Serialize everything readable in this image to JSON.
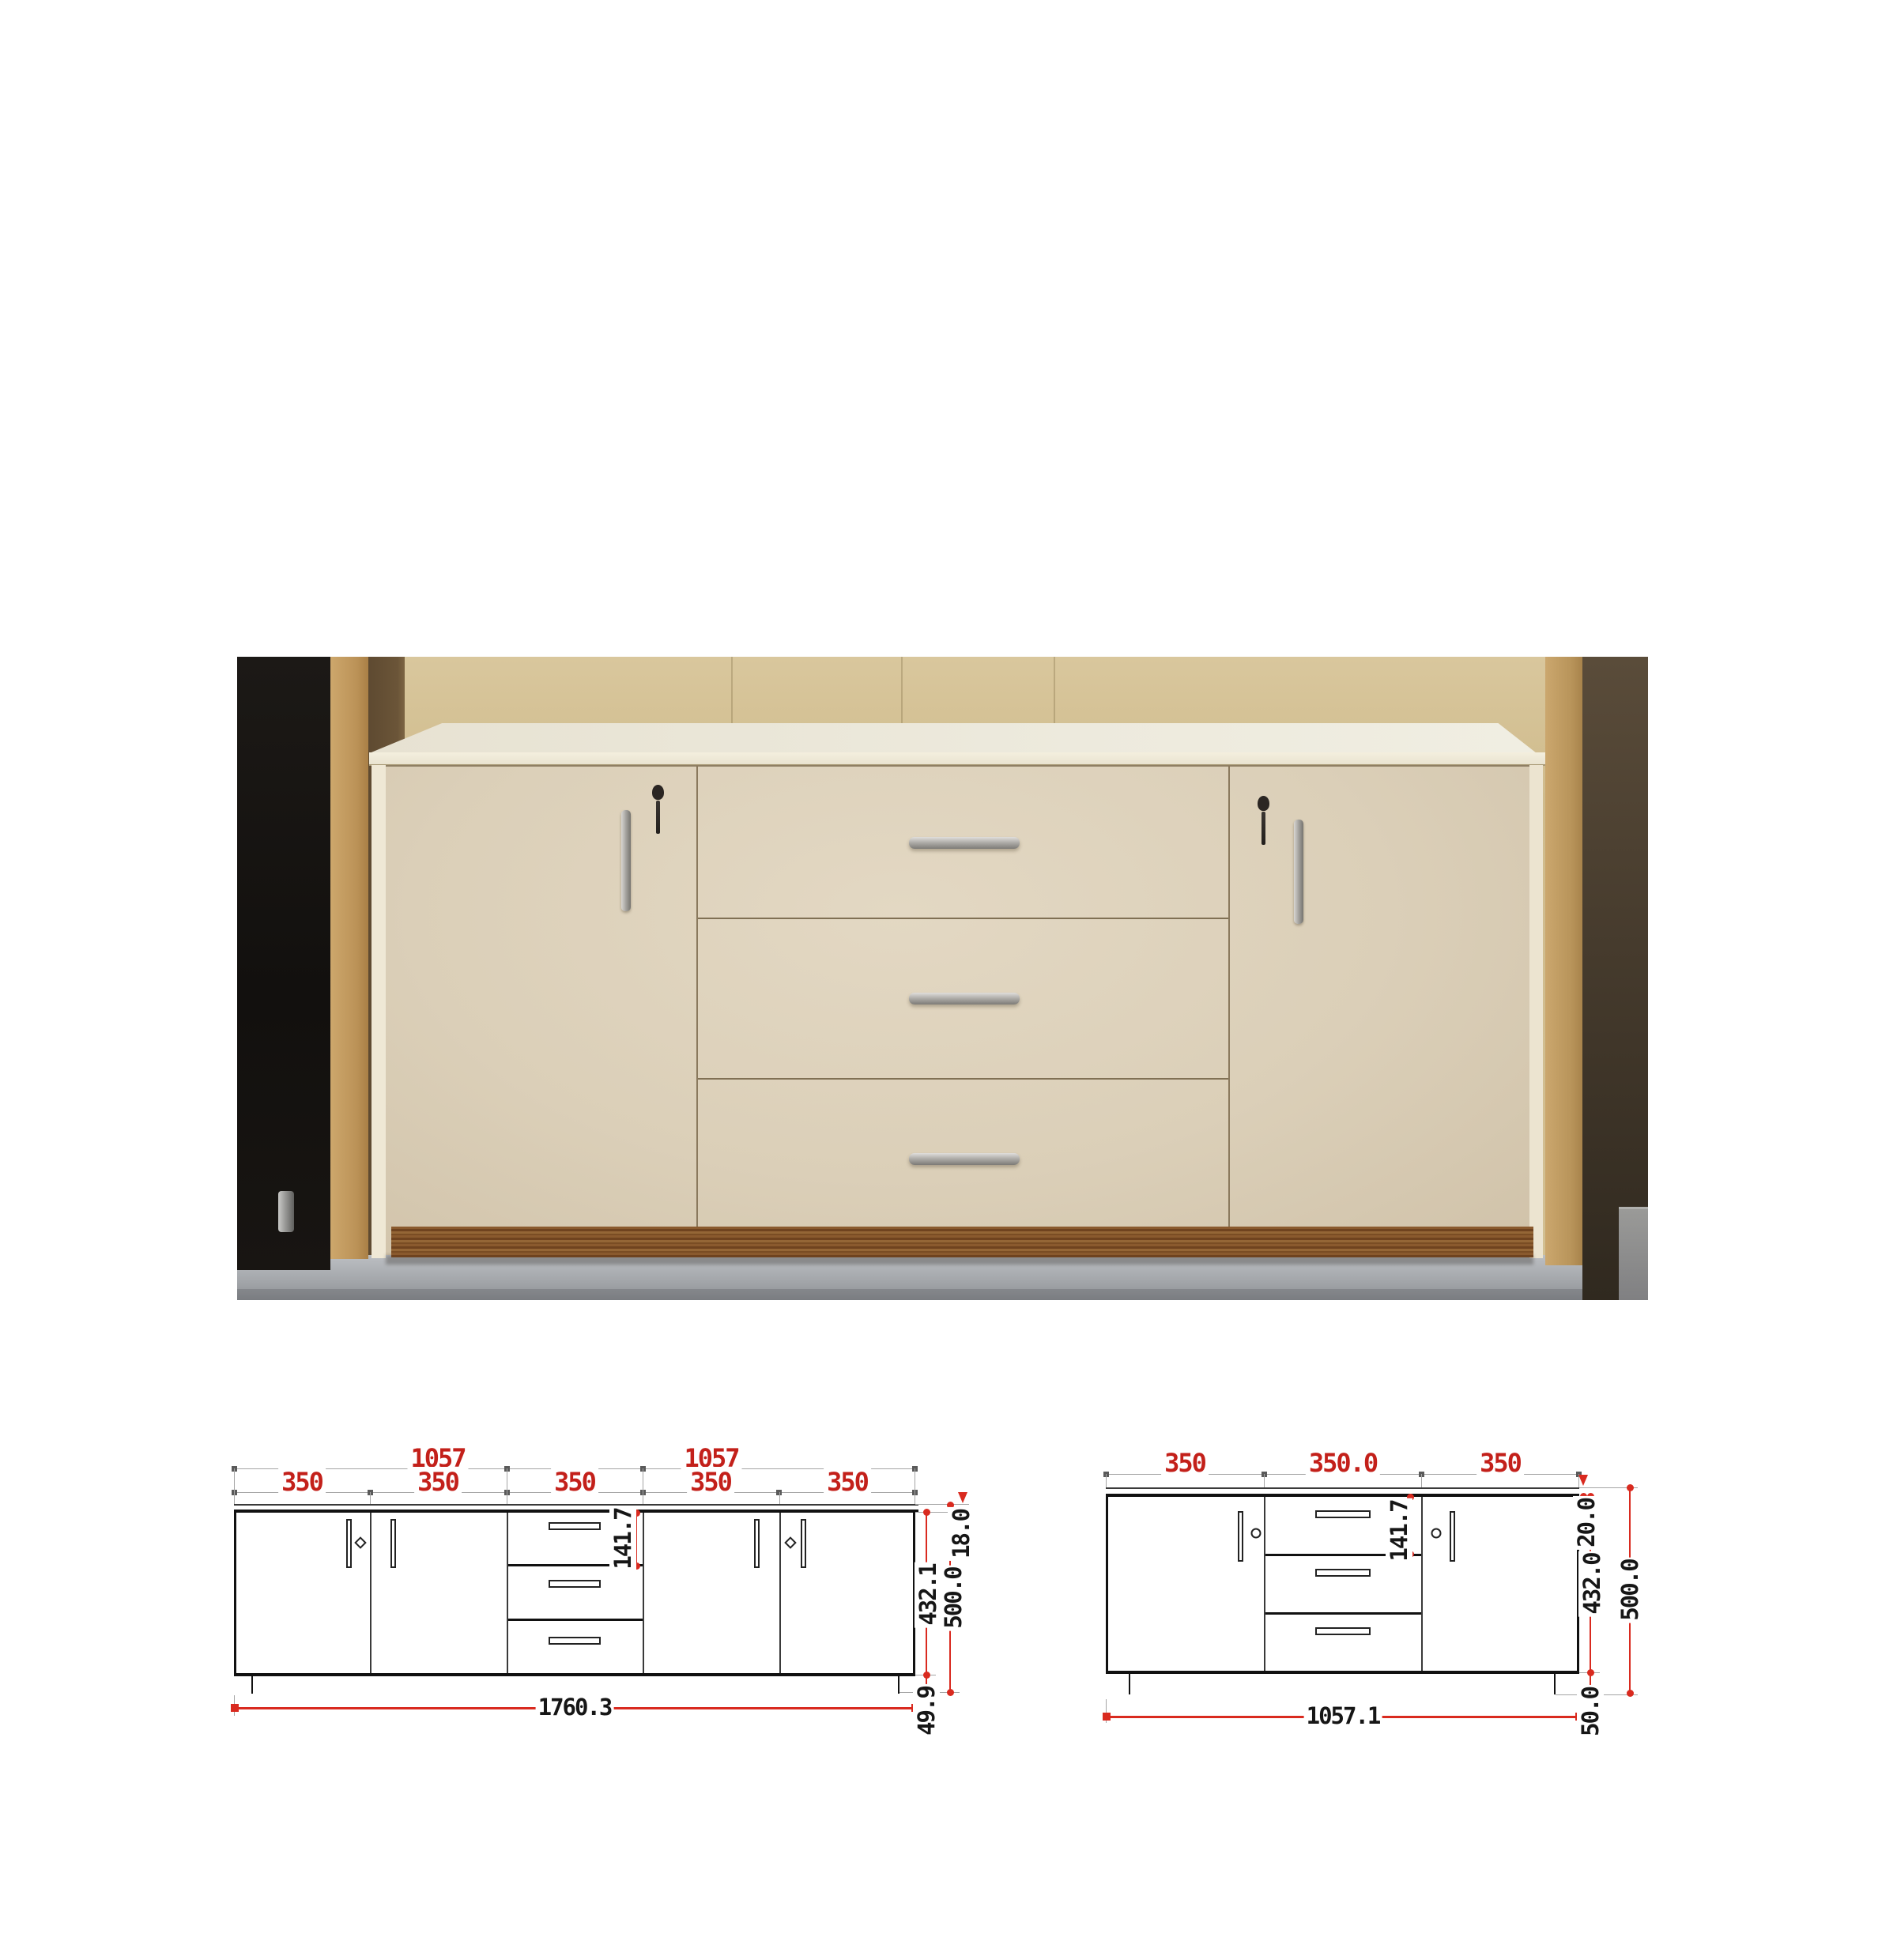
{
  "photo": {
    "description_colors": {
      "wall_beige": "#d3c093",
      "pillar_tan": "#bb9257",
      "tv_black": "#151210",
      "cabinet_cream": "#dbcfb8",
      "counter_white": "#f0eee2",
      "plinth_walnut": "#7a4d24",
      "floor_gray": "#a2a5a9",
      "handle_chrome": "#a9a7a3"
    }
  },
  "front_elevation": {
    "upper_widths": [
      "1057",
      "1057"
    ],
    "section_widths": [
      "350",
      "350",
      "350",
      "350",
      "350"
    ],
    "drawer_front_height": "141.7",
    "top_panel_thickness": "18.0",
    "carcass_height": "432.1",
    "overall_height": "500.0",
    "plinth_height": "49.9",
    "overall_width": "1760.3"
  },
  "compact_elevation": {
    "section_widths": [
      "350",
      "350.0",
      "350"
    ],
    "drawer_front_height": "141.7",
    "top_panel_thickness": "20.0",
    "carcass_height": "432.0",
    "overall_height": "500.0",
    "plinth_height": "50.0",
    "overall_width": "1057.1"
  },
  "dimension_style": {
    "width_label_color": "#c3201a",
    "height_label_color": "#161616",
    "dimension_line_color": "#d92a1f",
    "extension_line_color": "#a5a5a5"
  }
}
